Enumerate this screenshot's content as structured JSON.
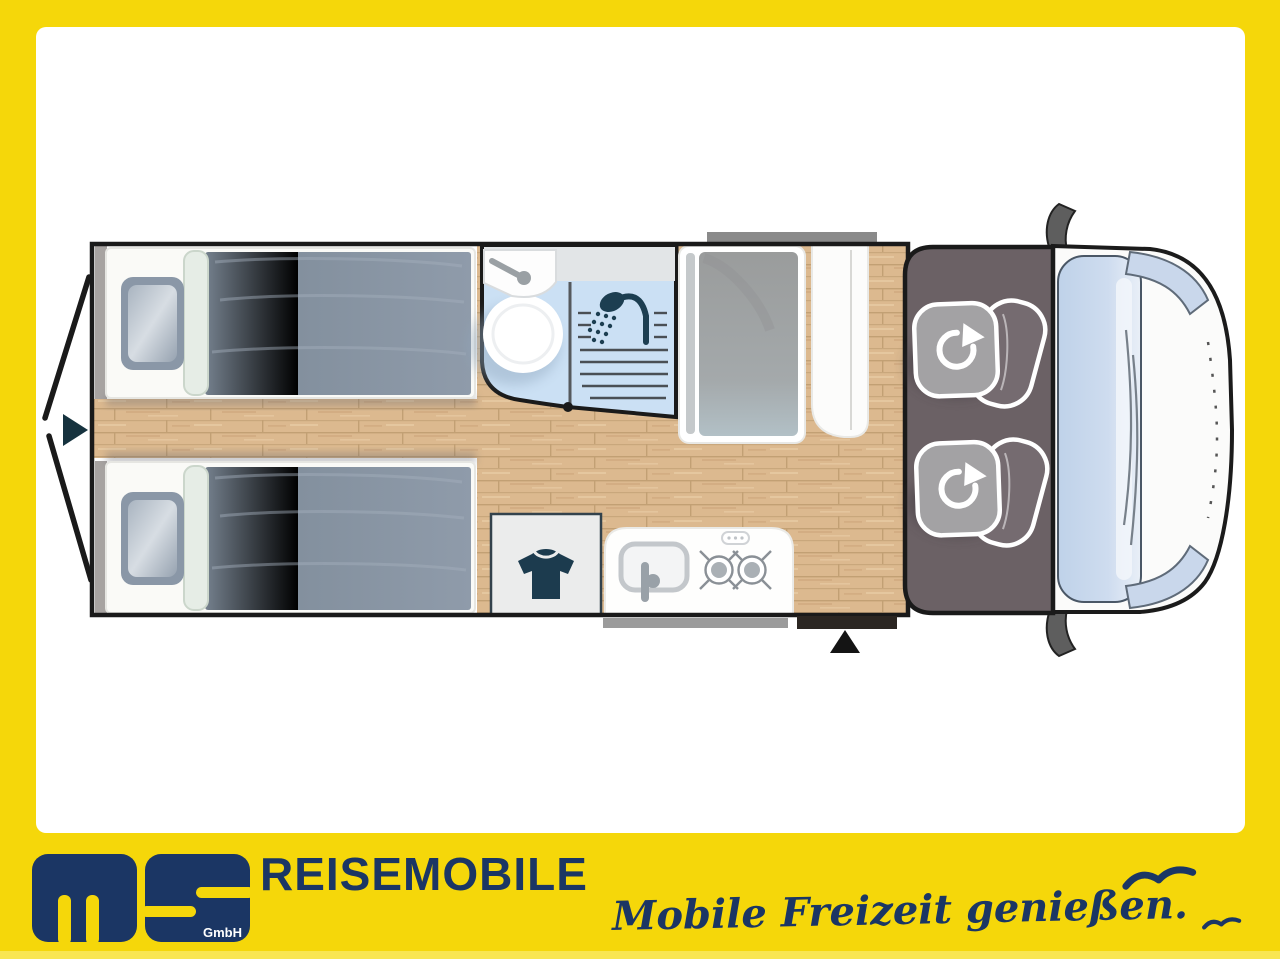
{
  "branding": {
    "logo_letters": "ms",
    "logo_sub": "GmbH",
    "brand": "REISEMOBILE",
    "tagline": "Mobile Freizeit genießen."
  },
  "colors": {
    "frame_yellow": "#F5D70A",
    "brand_navy": "#1B3664",
    "wood_floor": "#DCB98F",
    "bathroom_blue": "#CBE0F4",
    "cab_gray": "#6B6165",
    "mattress_gray": "#828E9C",
    "icon_teal": "#1C3E51",
    "windshield_blue": "#C3D4EA"
  },
  "floorplan": {
    "icons": {
      "rear_door_arrow": "right-triangle",
      "entry_arrow": "up-triangle",
      "wardrobe": "t-shirt",
      "shower": "shower-head",
      "swivel_seat": "rotate-arrow",
      "seagull": "gull"
    }
  }
}
